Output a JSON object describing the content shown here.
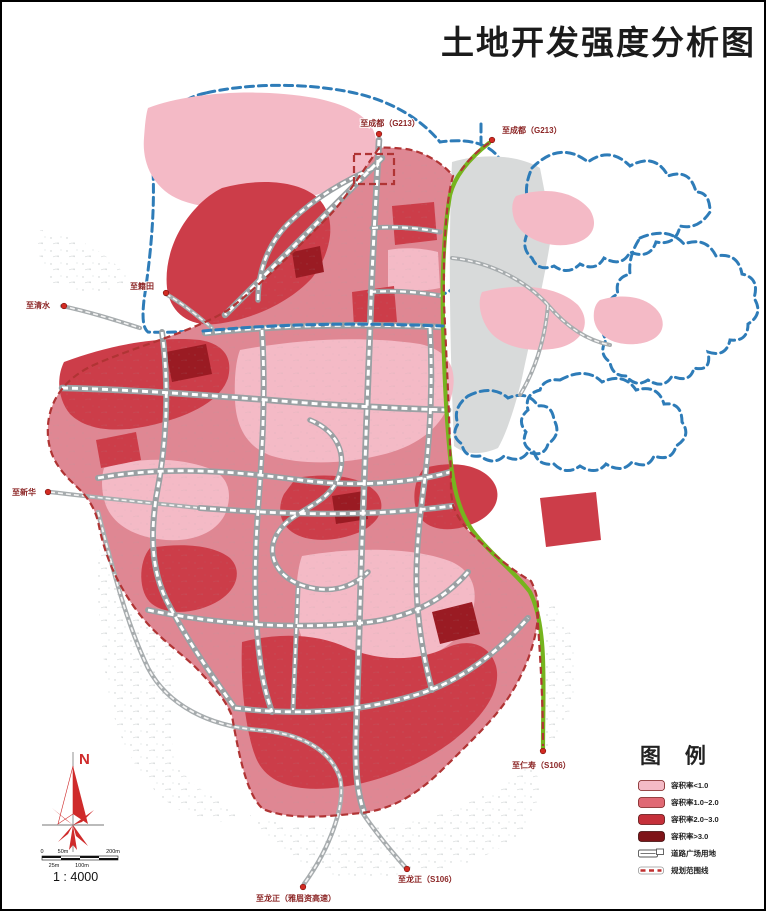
{
  "title": "土地开发强度分析图",
  "map": {
    "road_labels": [
      {
        "text": "至成都（G213）"
      },
      {
        "text": "至成都（G213）"
      },
      {
        "text": "至清水"
      },
      {
        "text": "至籍田"
      },
      {
        "text": "至新华"
      },
      {
        "text": "至仁寿（S106）"
      },
      {
        "text": "至龙正（S106）"
      },
      {
        "text": "至龙正（雅眉资高速）"
      }
    ],
    "colors": {
      "reservoir_boundary_blue": "#2e7cb8",
      "planning_boundary_red": "#b03434",
      "green_road": "#76b41e",
      "water_grey": "#d8dada"
    }
  },
  "legend": {
    "title": "图 例",
    "items": [
      {
        "label": "容积率<1.0",
        "color": "#f4bac6"
      },
      {
        "label": "容积率1.0~2.0",
        "color": "#e06974"
      },
      {
        "label": "容积率2.0~3.0",
        "color": "#c5303a"
      },
      {
        "label": "容积率>3.0",
        "color": "#7e1418"
      },
      {
        "label": "道路广场用地"
      },
      {
        "label": "规划范围线"
      }
    ]
  },
  "compass": {
    "north_label": "N"
  },
  "scale": {
    "ratio": "1 : 4000",
    "top_labels": [
      "0",
      "50m",
      "200m"
    ],
    "bottom_labels": [
      "25m",
      "100m"
    ]
  }
}
